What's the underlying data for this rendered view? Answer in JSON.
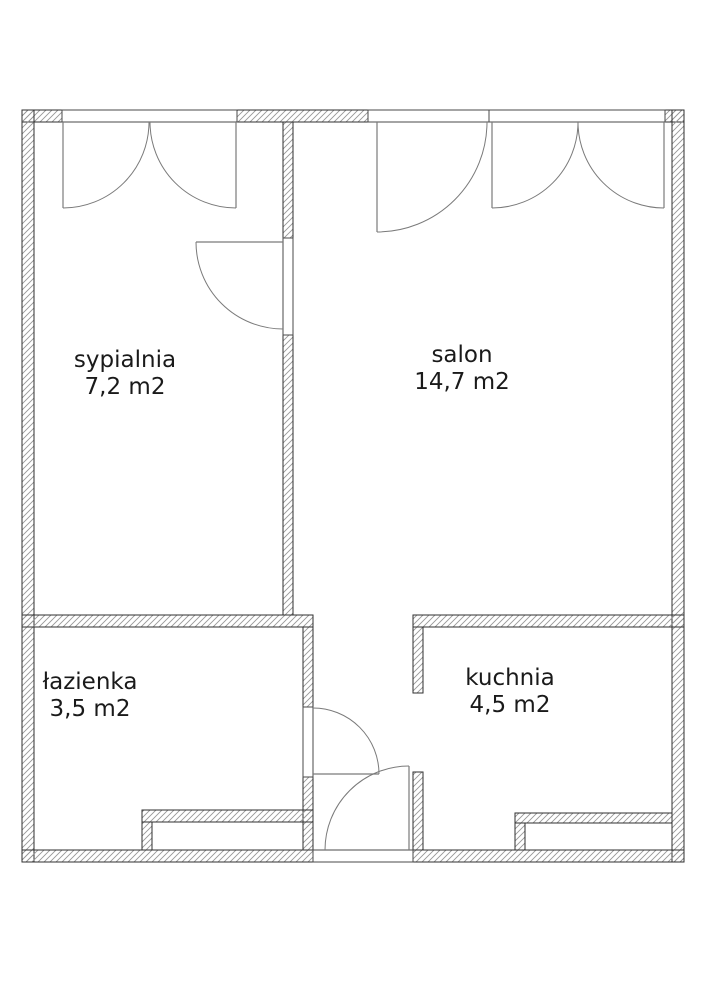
{
  "colors": {
    "background": "#ffffff",
    "wall_outline": "#2f2f2f",
    "wall_hatch": "#979797",
    "frame_outline": "#4a4a4a",
    "frame_fill": "#ffffff",
    "door_line": "#7a7a7a",
    "text": "#1a1a1a"
  },
  "rooms": [
    {
      "name": "sypialnia",
      "area": "7,2 m2",
      "cx": 125,
      "cy": 374
    },
    {
      "name": "salon",
      "area": "14,7 m2",
      "cx": 462,
      "cy": 369
    },
    {
      "name": "łazienka",
      "area": "3,5 m2",
      "cx": 90,
      "cy": 696
    },
    {
      "name": "kuchnia",
      "area": "4,5 m2",
      "cx": 510,
      "cy": 692
    }
  ],
  "plan": {
    "width": 707,
    "height": 1000,
    "walls": [
      {
        "r": [
          22,
          110,
          40,
          12
        ],
        "name": "outer-wall-top-left"
      },
      {
        "r": [
          237,
          110,
          131,
          12
        ],
        "name": "outer-wall-top-middle"
      },
      {
        "r": [
          665,
          110,
          19,
          12
        ],
        "name": "outer-wall-top-right"
      },
      {
        "r": [
          22,
          110,
          12,
          752
        ],
        "name": "outer-wall-left"
      },
      {
        "r": [
          672,
          110,
          12,
          752
        ],
        "name": "outer-wall-right"
      },
      {
        "r": [
          22,
          850,
          291,
          12
        ],
        "name": "outer-wall-bottom-left"
      },
      {
        "r": [
          413,
          850,
          271,
          12
        ],
        "name": "outer-wall-bottom-right"
      },
      {
        "r": [
          283,
          122,
          10,
          116
        ],
        "name": "divider-wall-bedroom-salon-upper"
      },
      {
        "r": [
          283,
          335,
          10,
          280
        ],
        "name": "divider-wall-bedroom-salon-lower"
      },
      {
        "r": [
          22,
          615,
          291,
          12
        ],
        "name": "waist-wall-bathroom-top"
      },
      {
        "r": [
          413,
          615,
          271,
          12
        ],
        "name": "waist-wall-kitchen-top"
      },
      {
        "r": [
          303,
          627,
          10,
          80
        ],
        "name": "hall-wall-upper"
      },
      {
        "r": [
          303,
          777,
          10,
          73
        ],
        "name": "hall-wall-lower"
      },
      {
        "r": [
          413,
          627,
          10,
          66
        ],
        "name": "kitchen-left-wall-upper"
      },
      {
        "r": [
          413,
          772,
          10,
          78
        ],
        "name": "kitchen-left-wall-lower"
      },
      {
        "r": [
          142,
          810,
          171,
          12
        ],
        "name": "bathroom-duct-top"
      },
      {
        "r": [
          142,
          822,
          10,
          28
        ],
        "name": "bathroom-duct-left"
      },
      {
        "r": [
          515,
          813,
          157,
          10
        ],
        "name": "kitchen-duct-top"
      },
      {
        "r": [
          515,
          823,
          10,
          27
        ],
        "name": "kitchen-duct-left"
      }
    ],
    "frames": [
      {
        "r": [
          62,
          110,
          175,
          12
        ],
        "name": "window-frame-bedroom"
      },
      {
        "r": [
          368,
          110,
          121,
          12
        ],
        "name": "door-frame-balcony"
      },
      {
        "r": [
          489,
          110,
          176,
          12
        ],
        "name": "window-frame-salon"
      },
      {
        "r": [
          283,
          238,
          10,
          97
        ],
        "name": "door-frame-bedroom"
      },
      {
        "r": [
          303,
          707,
          10,
          70
        ],
        "name": "door-frame-bathroom"
      },
      {
        "r": [
          313,
          850,
          100,
          12
        ],
        "name": "door-frame-entrance"
      }
    ],
    "doors": [
      {
        "name": "door-bedroom",
        "leaf": [
          283,
          242,
          196,
          242
        ],
        "arc": "M 196 242 A 87 87 0 0 0 283 329"
      },
      {
        "name": "door-bathroom",
        "leaf": [
          313,
          774,
          379,
          774
        ],
        "arc": "M 313 708 A 66 66 0 0 1 379 774"
      },
      {
        "name": "door-entrance",
        "leaf": [
          409,
          850,
          409,
          766
        ],
        "arc": "M 325 850 A 84 84 0 0 1 409 766"
      },
      {
        "name": "door-balcony",
        "leaf": [
          377,
          122,
          377,
          232
        ],
        "arc": "M 487 122 A 110 110 0 0 1 377 232"
      }
    ],
    "windows": [
      {
        "name": "window-bedroom",
        "leaves": [
          [
            63,
            122,
            63,
            208
          ],
          [
            236,
            122,
            236,
            208
          ]
        ],
        "arcs": [
          "M 63 208 A 86 86 0 0 0 149 122",
          "M 236 208 A 86 86 0 0 1 150 122"
        ]
      },
      {
        "name": "window-salon",
        "leaves": [
          [
            492,
            122,
            492,
            208
          ],
          [
            664,
            122,
            664,
            208
          ]
        ],
        "arcs": [
          "M 492 208 A 86 86 0 0 0 578 122",
          "M 664 208 A 86 86 0 0 1 578 122"
        ]
      }
    ]
  }
}
